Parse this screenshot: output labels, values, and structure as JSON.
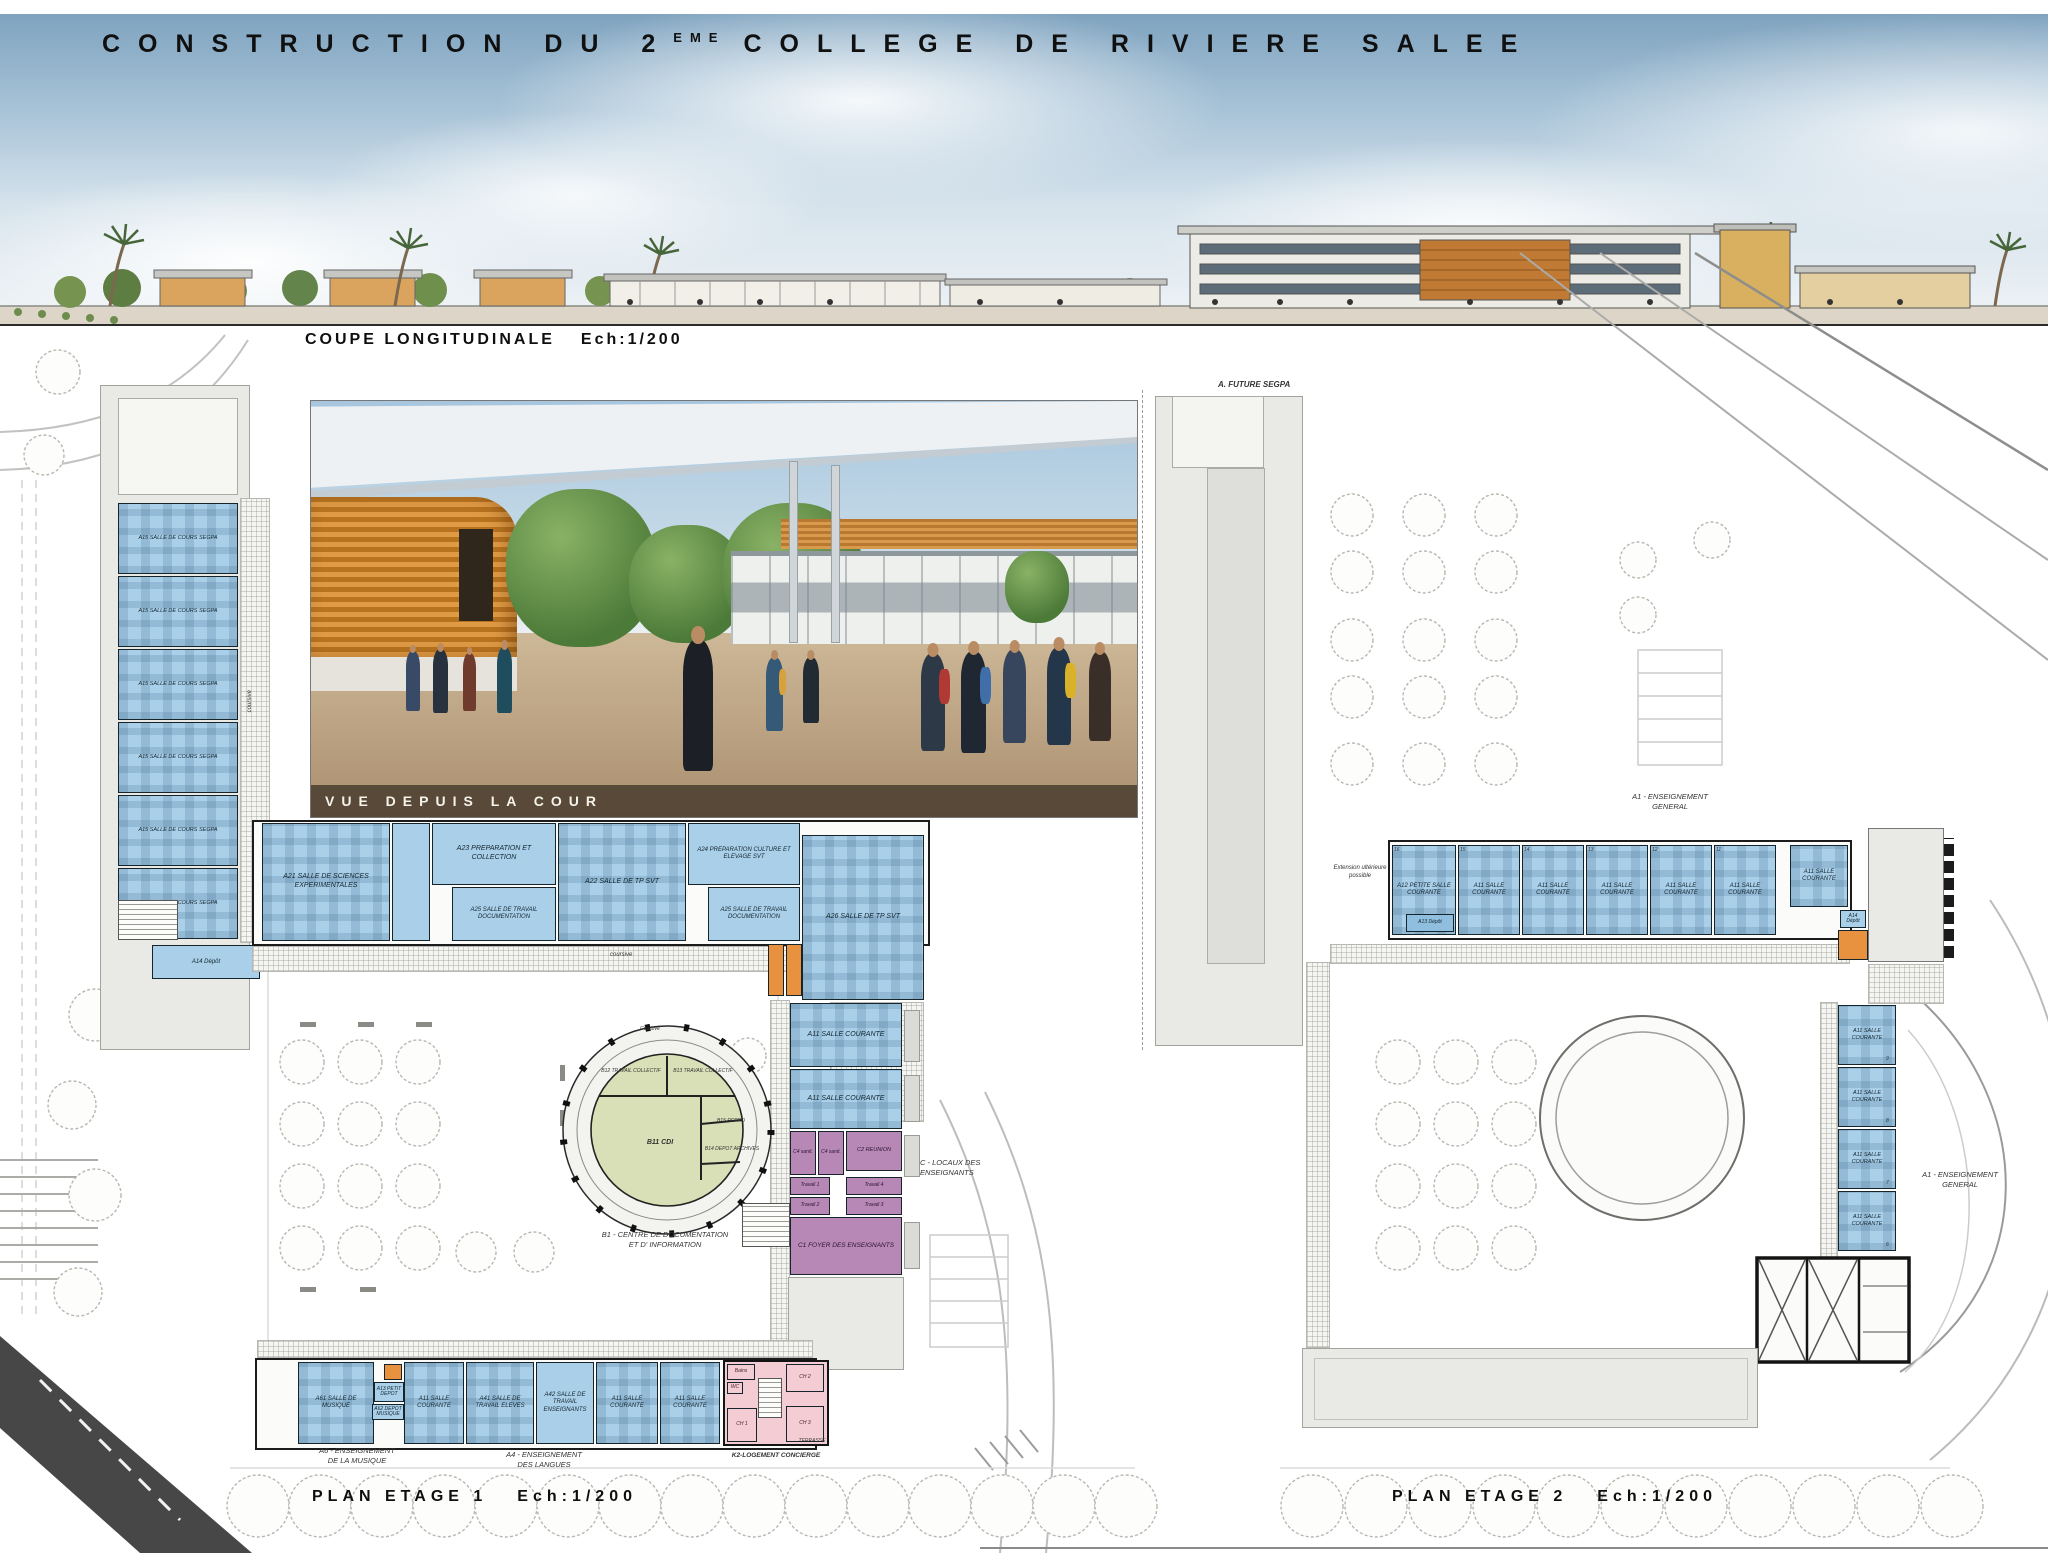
{
  "title": {
    "part1": "CONSTRUCTION DU 2",
    "sup": "EME",
    "part2": "COLLEGE DE RIVIERE SALEE"
  },
  "section": {
    "caption": "COUPE LONGITUDINALE",
    "scale": "Ech:1/200"
  },
  "perspective": {
    "caption": "VUE DEPUIS LA COUR"
  },
  "plan1": {
    "caption": "PLAN ETAGE 1",
    "scale": "Ech:1/200",
    "coursive": "coursive",
    "segpa_room": "A15 SALLE DE COURS SEGPA",
    "depot_a14": "A14 Dépôt",
    "top_rooms": [
      "A21 SALLE DE SCIENCES EXPERIMENTALES",
      "A23 PREPARATION ET COLLECTION",
      "A25 SALLE DE TRAVAIL DOCUMENTATION",
      "A22 SALLE DE TP SVT",
      "A24 PREPARATION CULTURE ET ELEVAGE SVT",
      "A25 SALLE DE TRAVAIL DOCUMENTATION",
      "A26 SALLE DE TP SVT"
    ],
    "right_rooms": [
      "A11 SALLE COURANTE",
      "A11 SALLE COURANTE"
    ],
    "enseignants": {
      "sanit": "C4 sanit.",
      "reunion": "C2 REUNION",
      "travail1": "Travail 1",
      "travail2": "Travail 2",
      "travail3": "Travail 3",
      "travail4": "Travail 4",
      "foyer": "C1 FOYER DES ENSEIGNANTS",
      "label1": "C - LOCAUX DES",
      "label2": "ENSEIGNANTS"
    },
    "cdi": {
      "ring": "Coursive",
      "main": "B11 CDI",
      "col1": "B12 TRAVAIL COLLECTIF",
      "col2": "B13 TRAVAIL COLLECTIF",
      "repro": "B15 REPRO",
      "archives": "B14 DEPOT ARCHIVES",
      "caption1": "B1 - CENTRE DE DOCUMENTATION",
      "caption2": "ET D' INFORMATION"
    },
    "bottom_rooms": [
      "A61 SALLE DE MUSIQUE",
      "A13 PETIT DEPOT",
      "A62 DEPOT MUSIQUE",
      "A11 SALLE COURANTE",
      "A41 SALLE DE TRAVAIL ELEVES",
      "A42 SALLE DE TRAVAIL ENSEIGNANTS",
      "A11 SALLE COURANTE",
      "A11 SALLE COURANTE"
    ],
    "concierge": {
      "bains": "Bains",
      "wc": "WC",
      "ch1": "CH 1",
      "ch2": "CH 2",
      "ch3": "CH 3",
      "terrasse": "TERRASSE",
      "caption": "K2-LOGEMENT CONCIERGE"
    },
    "musique_label1": "A6 - ENSEIGNEMENT",
    "musique_label2": "DE LA MUSIQUE",
    "langues_label1": "A4 - ENSEIGNEMENT",
    "langues_label2": "DES LANGUES"
  },
  "plan2": {
    "caption": "PLAN ETAGE 2",
    "scale": "Ech:1/200",
    "future_segpa": "A. FUTURE SEGPA",
    "extension1": "Extension ultérieure",
    "extension2": "possible",
    "general1": "A1 - ENSEIGNEMENT",
    "general2": "GENERAL",
    "petite_salle": "A12 PETITE SALLE COURANTE",
    "depot_a13": "A13 Dépôt",
    "salle_courante": "A11 SALLE COURANTE",
    "depot_a14": "A14 Dépôt",
    "top_numbers": [
      "16",
      "15",
      "14",
      "13",
      "12",
      "11"
    ],
    "right_numbers": [
      "9",
      "8",
      "7",
      "6"
    ]
  },
  "colors": {
    "room_blue": "#a9cfe9",
    "cdi_green": "#d9dfb6",
    "enseignants_purple": "#b787b5",
    "concierge_pink": "#f3cdd3",
    "accent_orange": "#e8913f",
    "wall": "#16242c"
  }
}
